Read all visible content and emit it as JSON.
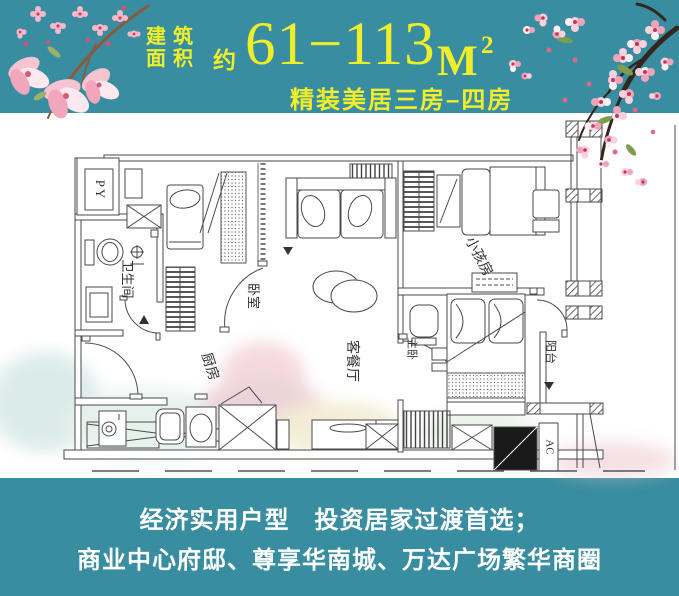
{
  "poster": {
    "background_color": "#388da0",
    "accent_color": "#f0ee2a",
    "text_color": "#ffffff"
  },
  "header": {
    "area_label_line1": "建筑",
    "area_label_line2": "面积",
    "approx": "约",
    "area_value": "61−113",
    "unit": "M",
    "unit_exponent": "2",
    "subtitle": "精装美居三房–四房"
  },
  "floorplan": {
    "labels": {
      "py": "PY",
      "bathroom": "卫生间",
      "bedroom": "卧室",
      "kitchen": "厨房",
      "living_dining": "客餐厅",
      "kids_room": "小孩房",
      "master_bedroom": "主卧",
      "balcony": "阳台",
      "ac": "AC"
    }
  },
  "footer": {
    "line1": "经济实用户型　投资居家过渡首选；",
    "line2": "商业中心府邸、尊享华南城、万达广场繁华商圈"
  }
}
